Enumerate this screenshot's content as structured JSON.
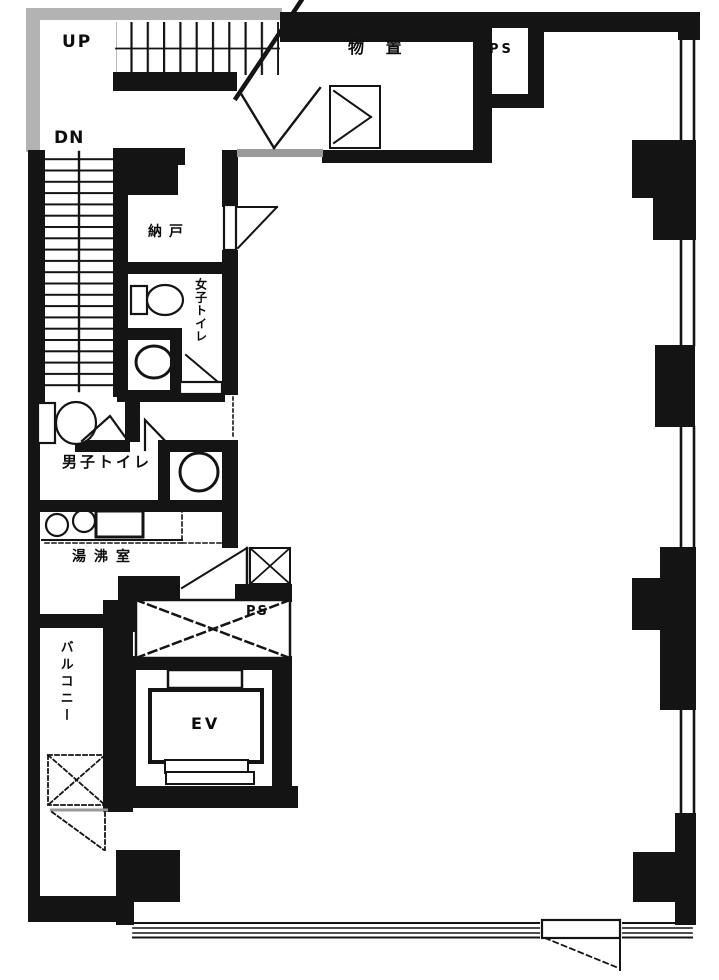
{
  "colors": {
    "wall": "#141414",
    "bg": "#ffffff",
    "gray": "#b3b3b3",
    "threshold": "#9a9a9a"
  },
  "floorplan": {
    "type": "building-floor-plan",
    "labels": {
      "stairs_up": "UP",
      "stairs_down": "DN",
      "storage_room": "物 置",
      "pipe_shaft_top": "PS",
      "closet": "納戸",
      "womens_toilet": "女子トイレ",
      "mens_toilet": "男子トイレ",
      "kitchenette": "湯沸室",
      "balcony": "バルコニー",
      "pipe_shaft_mid": "PS",
      "elevator": "EV"
    }
  }
}
